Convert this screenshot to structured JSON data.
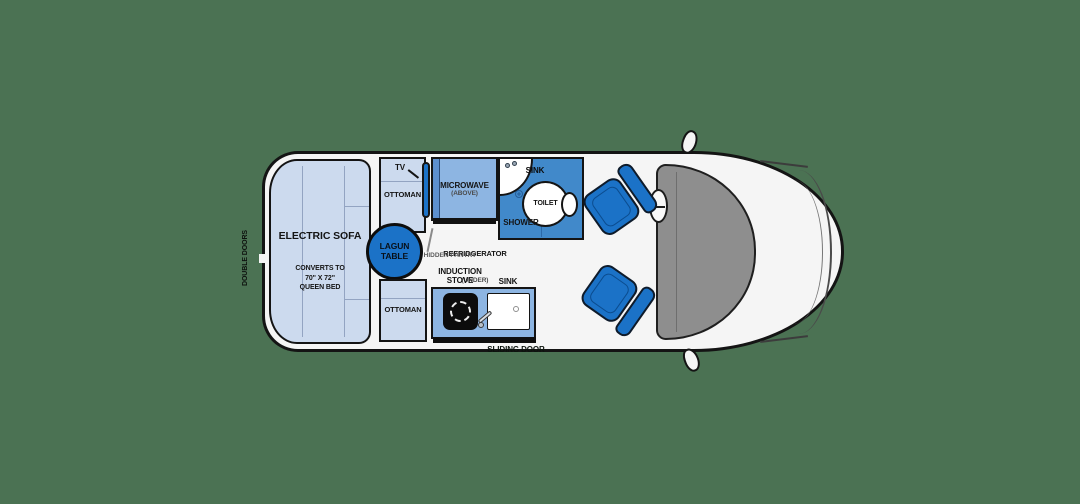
{
  "colors": {
    "bg": "#4b7253",
    "accent": "#1b72c7",
    "light": "#ccdaee",
    "mid": "#8db5e2",
    "bath": "#4189ca",
    "body": "#f5f5f5",
    "glass": "#8e8e8e",
    "ink": "#141414"
  },
  "exterior": {
    "double_doors_label": "DOUBLE DOORS",
    "sliding_door_label": "SLIDING DOOR"
  },
  "living": {
    "sofa": {
      "title": "ELECTRIC SOFA",
      "subtitle": "CONVERTS TO\n70\" X 72\"\nQUEEN BED"
    },
    "tv_label": "TV",
    "ottoman_top_label": "OTTOMAN",
    "ottoman_bottom_label": "OTTOMAN",
    "table_label": "LAGUN\nTABLE",
    "microwave": {
      "title": "MICROWAVE",
      "subtitle": "(ABOVE)"
    },
    "refrigerator": {
      "title": "REFRIDGERATOR",
      "subtitle": "(UNDER)"
    },
    "hidden_pantry_label": "HIDDEN PANTRY"
  },
  "galley": {
    "stove_label": "INDUCTION\nSTOVE",
    "sink_label": "SINK"
  },
  "bathroom": {
    "sink_label": "SINK",
    "toilet_label": "TOILET",
    "shower_label": "SHOWER"
  }
}
